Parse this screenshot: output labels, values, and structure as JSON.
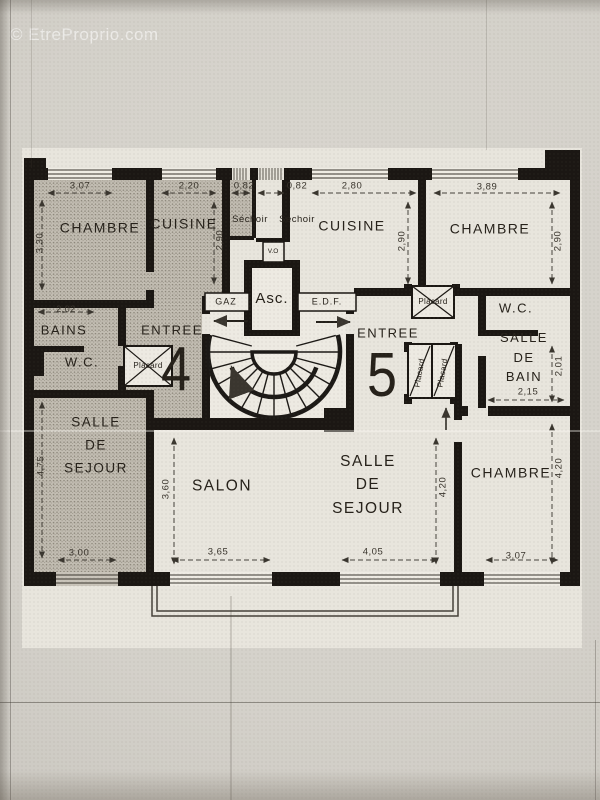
{
  "watermark": "© EtreProprio.com",
  "plan": {
    "apartments": {
      "left": "4",
      "right": "5"
    },
    "labels": {
      "chambre_nw": "CHAMBRE",
      "cuisine_w": "CUISINE",
      "sechoir_1": "Séchoir",
      "sechoir_2": "Séchoir",
      "vide_ordures": "V.O",
      "ascenseur": "Asc.",
      "gaz": "GAZ",
      "edf": "E.D.F.",
      "cuisine_e": "CUISINE",
      "chambre_ne": "CHAMBRE",
      "placard_ne": "Placard",
      "wc_ne": "W.C.",
      "bains": "BAINS",
      "wc_w": "W.C.",
      "placard_w": "Placard",
      "entree_w": "ENTREE",
      "entree_e": "ENTREE",
      "placard_e1": "Placard",
      "placard_e2": "Placard",
      "salle_de_bain": "SALLE\nDE\nBAIN",
      "sejour_w": "SALLE\nDE\nSEJOUR",
      "salon": "SALON",
      "sejour_e": "SALLE\nDE\nSEJOUR",
      "chambre_se": "CHAMBRE"
    },
    "dims": {
      "top": [
        "3,07",
        "2,20",
        "0,82",
        "0,82",
        "2,80",
        "3,89"
      ],
      "bottom": [
        "3,00",
        "3,65",
        "4,05",
        "3,07"
      ],
      "left": [
        "3,30",
        "2,02",
        "4,75"
      ],
      "inner": {
        "cuisine_w_h": "2,90",
        "cuisine_e_h": "2,90",
        "chambre_ne_h": "2,90",
        "bain_h": "2,01",
        "bain_w": "2,15",
        "salon_h": "3,60",
        "sejour_e_h": "4,20",
        "chambre_se_h": "4,20"
      }
    }
  }
}
